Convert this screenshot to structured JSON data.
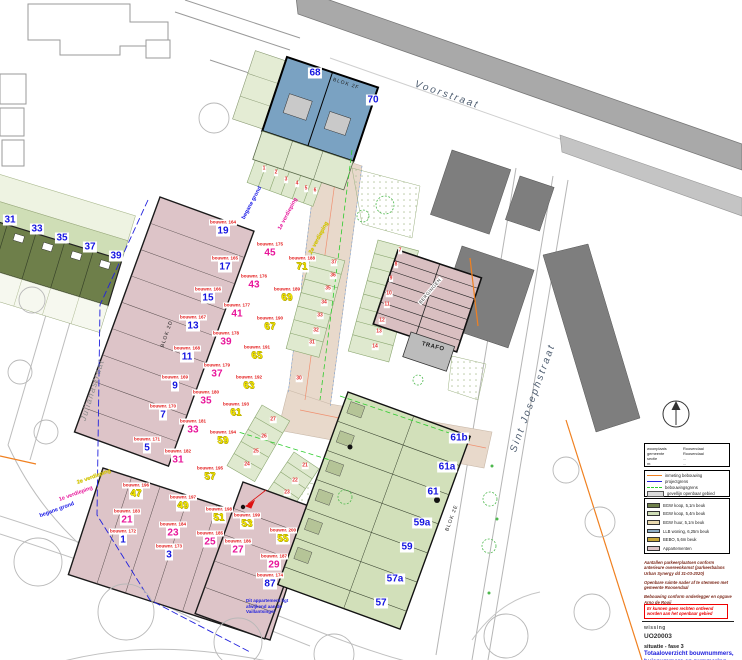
{
  "plan": {
    "rot_labels": [
      {
        "t": "Voorstraat",
        "x": 447,
        "y": 95,
        "rot": 19,
        "cls": "st"
      },
      {
        "t": "Sint Josephstraat",
        "x": 533,
        "y": 398,
        "rot": -70,
        "cls": "st"
      },
      {
        "t": "Julianastraat",
        "x": 92,
        "y": 390,
        "rot": -73,
        "cls": "st2"
      },
      {
        "t": "BLOK 2F",
        "x": 346,
        "y": 84,
        "rot": 18,
        "cls": "blok"
      },
      {
        "t": "BLOK 2D",
        "x": 167,
        "y": 334,
        "rot": -71,
        "cls": "blok"
      },
      {
        "t": "BLOK 2E",
        "x": 452,
        "y": 518,
        "rot": -70,
        "cls": "blok"
      },
      {
        "t": "begane grond",
        "x": 252,
        "y": 203,
        "rot": -62,
        "cls": "lv-b"
      },
      {
        "t": "1e verdieping",
        "x": 288,
        "y": 214,
        "rot": -62,
        "cls": "lv-m"
      },
      {
        "t": "2e verdieping",
        "x": 319,
        "y": 238,
        "rot": -62,
        "cls": "lv-y"
      },
      {
        "t": "2e verdieping",
        "x": 94,
        "y": 477,
        "rot": -20,
        "cls": "lv-y"
      },
      {
        "t": "1e verdieping",
        "x": 76,
        "y": 494,
        "rot": -20,
        "cls": "lv-m"
      },
      {
        "t": "begane grond",
        "x": 57,
        "y": 510,
        "rot": -20,
        "cls": "lv-b"
      },
      {
        "t": "TRAFO",
        "x": 433,
        "y": 347,
        "rot": 14,
        "cls": "trafo"
      },
      {
        "t": "BERGINGEN",
        "x": 430,
        "y": 291,
        "rot": -50,
        "cls": "berg"
      }
    ],
    "houses": [
      {
        "n": "68",
        "b": "",
        "c": "blue",
        "x": 315,
        "y": 73
      },
      {
        "n": "70",
        "b": "",
        "c": "blue",
        "x": 373,
        "y": 100
      },
      {
        "n": "31",
        "b": "",
        "c": "blue",
        "x": 10,
        "y": 220
      },
      {
        "n": "33",
        "b": "",
        "c": "blue",
        "x": 37,
        "y": 229
      },
      {
        "n": "35",
        "b": "",
        "c": "blue",
        "x": 62,
        "y": 238
      },
      {
        "n": "37",
        "b": "",
        "c": "blue",
        "x": 90,
        "y": 247
      },
      {
        "n": "39",
        "b": "",
        "c": "blue",
        "x": 116,
        "y": 256
      },
      {
        "n": "19",
        "b": "bouwnr. 164",
        "c": "blue",
        "x": 223,
        "y": 228
      },
      {
        "n": "17",
        "b": "bouwnr. 165",
        "c": "blue",
        "x": 225,
        "y": 264
      },
      {
        "n": "15",
        "b": "bouwnr. 166",
        "c": "blue",
        "x": 208,
        "y": 295
      },
      {
        "n": "13",
        "b": "bouwnr. 167",
        "c": "blue",
        "x": 193,
        "y": 323
      },
      {
        "n": "11",
        "b": "bouwnr. 168",
        "c": "blue",
        "x": 187,
        "y": 354
      },
      {
        "n": "9",
        "b": "bouwnr. 169",
        "c": "blue",
        "x": 175,
        "y": 383
      },
      {
        "n": "7",
        "b": "bouwnr. 170",
        "c": "blue",
        "x": 163,
        "y": 412
      },
      {
        "n": "5",
        "b": "bouwnr. 171",
        "c": "blue",
        "x": 147,
        "y": 445
      },
      {
        "n": "1",
        "b": "bouwnr. 172",
        "c": "blue",
        "x": 123,
        "y": 537
      },
      {
        "n": "3",
        "b": "bouwnr. 173",
        "c": "blue",
        "x": 169,
        "y": 552
      },
      {
        "n": "87",
        "b": "bouwnr. 174",
        "c": "blue",
        "x": 270,
        "y": 581
      },
      {
        "n": "57",
        "b": "",
        "c": "blue",
        "x": 381,
        "y": 603
      },
      {
        "n": "57a",
        "b": "",
        "c": "blue",
        "x": 395,
        "y": 579
      },
      {
        "n": "59",
        "b": "",
        "c": "blue",
        "x": 407,
        "y": 547
      },
      {
        "n": "59a",
        "b": "",
        "c": "blue",
        "x": 422,
        "y": 523
      },
      {
        "n": "61",
        "b": "",
        "c": "blue",
        "x": 433,
        "y": 492
      },
      {
        "n": "61a",
        "b": "",
        "c": "blue",
        "x": 447,
        "y": 467
      },
      {
        "n": "61b",
        "b": "",
        "c": "blue",
        "x": 459,
        "y": 438
      },
      {
        "n": "45",
        "b": "bouwnr. 175",
        "c": "mag",
        "x": 270,
        "y": 250
      },
      {
        "n": "43",
        "b": "bouwnr. 176",
        "c": "mag",
        "x": 254,
        "y": 282
      },
      {
        "n": "41",
        "b": "bouwnr. 177",
        "c": "mag",
        "x": 237,
        "y": 311
      },
      {
        "n": "39",
        "b": "bouwnr. 178",
        "c": "mag",
        "x": 226,
        "y": 339
      },
      {
        "n": "37",
        "b": "bouwnr. 179",
        "c": "mag",
        "x": 217,
        "y": 371
      },
      {
        "n": "35",
        "b": "bouwnr. 180",
        "c": "mag",
        "x": 206,
        "y": 398
      },
      {
        "n": "33",
        "b": "bouwnr. 181",
        "c": "mag",
        "x": 193,
        "y": 427
      },
      {
        "n": "31",
        "b": "bouwnr. 182",
        "c": "mag",
        "x": 178,
        "y": 457
      },
      {
        "n": "21",
        "b": "bouwnr. 183",
        "c": "mag",
        "x": 127,
        "y": 517
      },
      {
        "n": "23",
        "b": "bouwnr. 184",
        "c": "mag",
        "x": 173,
        "y": 530
      },
      {
        "n": "25",
        "b": "bouwnr. 185",
        "c": "mag",
        "x": 210,
        "y": 539
      },
      {
        "n": "27",
        "b": "bouwnr. 186",
        "c": "mag",
        "x": 238,
        "y": 547
      },
      {
        "n": "29",
        "b": "bouwnr. 187",
        "c": "mag",
        "x": 274,
        "y": 562
      },
      {
        "n": "71",
        "b": "bouwnr. 188",
        "c": "yel",
        "x": 302,
        "y": 264
      },
      {
        "n": "69",
        "b": "bouwnr. 189",
        "c": "yel",
        "x": 287,
        "y": 295
      },
      {
        "n": "67",
        "b": "bouwnr. 190",
        "c": "yel",
        "x": 270,
        "y": 324
      },
      {
        "n": "65",
        "b": "bouwnr. 191",
        "c": "yel",
        "x": 257,
        "y": 353
      },
      {
        "n": "63",
        "b": "bouwnr. 192",
        "c": "yel",
        "x": 249,
        "y": 383
      },
      {
        "n": "61",
        "b": "bouwnr. 193",
        "c": "yel",
        "x": 236,
        "y": 410
      },
      {
        "n": "59",
        "b": "bouwnr. 194",
        "c": "yel",
        "x": 223,
        "y": 438
      },
      {
        "n": "57",
        "b": "bouwnr. 195",
        "c": "yel",
        "x": 210,
        "y": 474
      },
      {
        "n": "47",
        "b": "bouwnr. 196",
        "c": "yel",
        "x": 136,
        "y": 491
      },
      {
        "n": "49",
        "b": "bouwnr. 197",
        "c": "yel",
        "x": 183,
        "y": 503
      },
      {
        "n": "51",
        "b": "bouwnr. 198",
        "c": "yel",
        "x": 219,
        "y": 515
      },
      {
        "n": "53",
        "b": "bouwnr. 199",
        "c": "yel",
        "x": 247,
        "y": 521
      },
      {
        "n": "55",
        "b": "bouwnr. 200",
        "c": "yel",
        "x": 283,
        "y": 536
      }
    ],
    "parking": [
      {
        "n": "1",
        "x": 264,
        "y": 169
      },
      {
        "n": "2",
        "x": 276,
        "y": 173
      },
      {
        "n": "3",
        "x": 286,
        "y": 180
      },
      {
        "n": "4",
        "x": 297,
        "y": 184
      },
      {
        "n": "5",
        "x": 306,
        "y": 189
      },
      {
        "n": "6",
        "x": 315,
        "y": 191
      },
      {
        "n": "7",
        "x": 400,
        "y": 251
      },
      {
        "n": "8",
        "x": 396,
        "y": 265
      },
      {
        "n": "9",
        "x": 391,
        "y": 279
      },
      {
        "n": "10",
        "x": 389,
        "y": 294
      },
      {
        "n": "11",
        "x": 387,
        "y": 305
      },
      {
        "n": "12",
        "x": 382,
        "y": 321
      },
      {
        "n": "13",
        "x": 379,
        "y": 332
      },
      {
        "n": "14",
        "x": 375,
        "y": 347
      },
      {
        "n": "37",
        "x": 334,
        "y": 263
      },
      {
        "n": "36",
        "x": 333,
        "y": 276
      },
      {
        "n": "35",
        "x": 328,
        "y": 289
      },
      {
        "n": "34",
        "x": 324,
        "y": 303
      },
      {
        "n": "33",
        "x": 320,
        "y": 316
      },
      {
        "n": "32",
        "x": 316,
        "y": 331
      },
      {
        "n": "31",
        "x": 312,
        "y": 343
      },
      {
        "n": "30",
        "x": 299,
        "y": 379
      },
      {
        "n": "27",
        "x": 273,
        "y": 420
      },
      {
        "n": "26",
        "x": 264,
        "y": 437
      },
      {
        "n": "25",
        "x": 256,
        "y": 452
      },
      {
        "n": "24",
        "x": 247,
        "y": 465
      },
      {
        "n": "21",
        "x": 305,
        "y": 466
      },
      {
        "n": "22",
        "x": 295,
        "y": 481
      },
      {
        "n": "23",
        "x": 287,
        "y": 493
      }
    ],
    "apartment_note": {
      "l1": "Dit appartement ligt",
      "l2": "afwijkend aan de",
      "l3": "Vaillantsingel"
    }
  },
  "panel": {
    "cadastre": [
      {
        "k": "woonplaats",
        "v": "Roosendaal"
      },
      {
        "k": "gemeente",
        "v": "Roosendaal"
      },
      {
        "k": "sectie",
        "v": "..."
      },
      {
        "k": "nr.",
        "v": "..."
      }
    ],
    "legend_lines": [
      {
        "name": "inmeting bebouwing",
        "cls": "sym-orange"
      },
      {
        "name": "projectgrens",
        "cls": "sym-blue"
      },
      {
        "name": "bebouwingsgrens",
        "cls": "sym-green"
      },
      {
        "name": "gevellijn openbaar gebied",
        "cls": "sym-grayrect"
      }
    ],
    "legend_fills": [
      {
        "name": "BGW koop, 5,1m beuk",
        "color": "#6e7f4a"
      },
      {
        "name": "BGW koop, 5,4m beuk",
        "color": "#cfdeb6"
      },
      {
        "name": "BGW huur, 5,1m beuk",
        "color": "#ead9ae"
      },
      {
        "name": "LLB woning, 6,25m beuk",
        "color": "#8fb0c8"
      },
      {
        "name": "BEBO, 5,6m beuk",
        "color": "#c8a83c"
      },
      {
        "name": "Appartementen",
        "color": "#ddc4c8"
      }
    ],
    "notes": {
      "note1": "Aantallen parkeerplaatsen conform anterieure overeenkomst (parkeerbalans Urban Synergy dd 31-03-2020)",
      "note2": "Openbare ruimte nader af te stemmen met gemeente Roosendaal",
      "note3": "Bebouwing conform onderlegger en opgave Arno de Rooij",
      "warning": "Er kunnen geen rechten ontleend worden aan het openbaar gebied"
    },
    "title": {
      "firm": "wissing",
      "code": "UO20003",
      "phase": "situatie - fase 3",
      "sheet": "Totaaloverzicht bouwnummers,",
      "sheet2": "huisnummers en nummering"
    }
  }
}
